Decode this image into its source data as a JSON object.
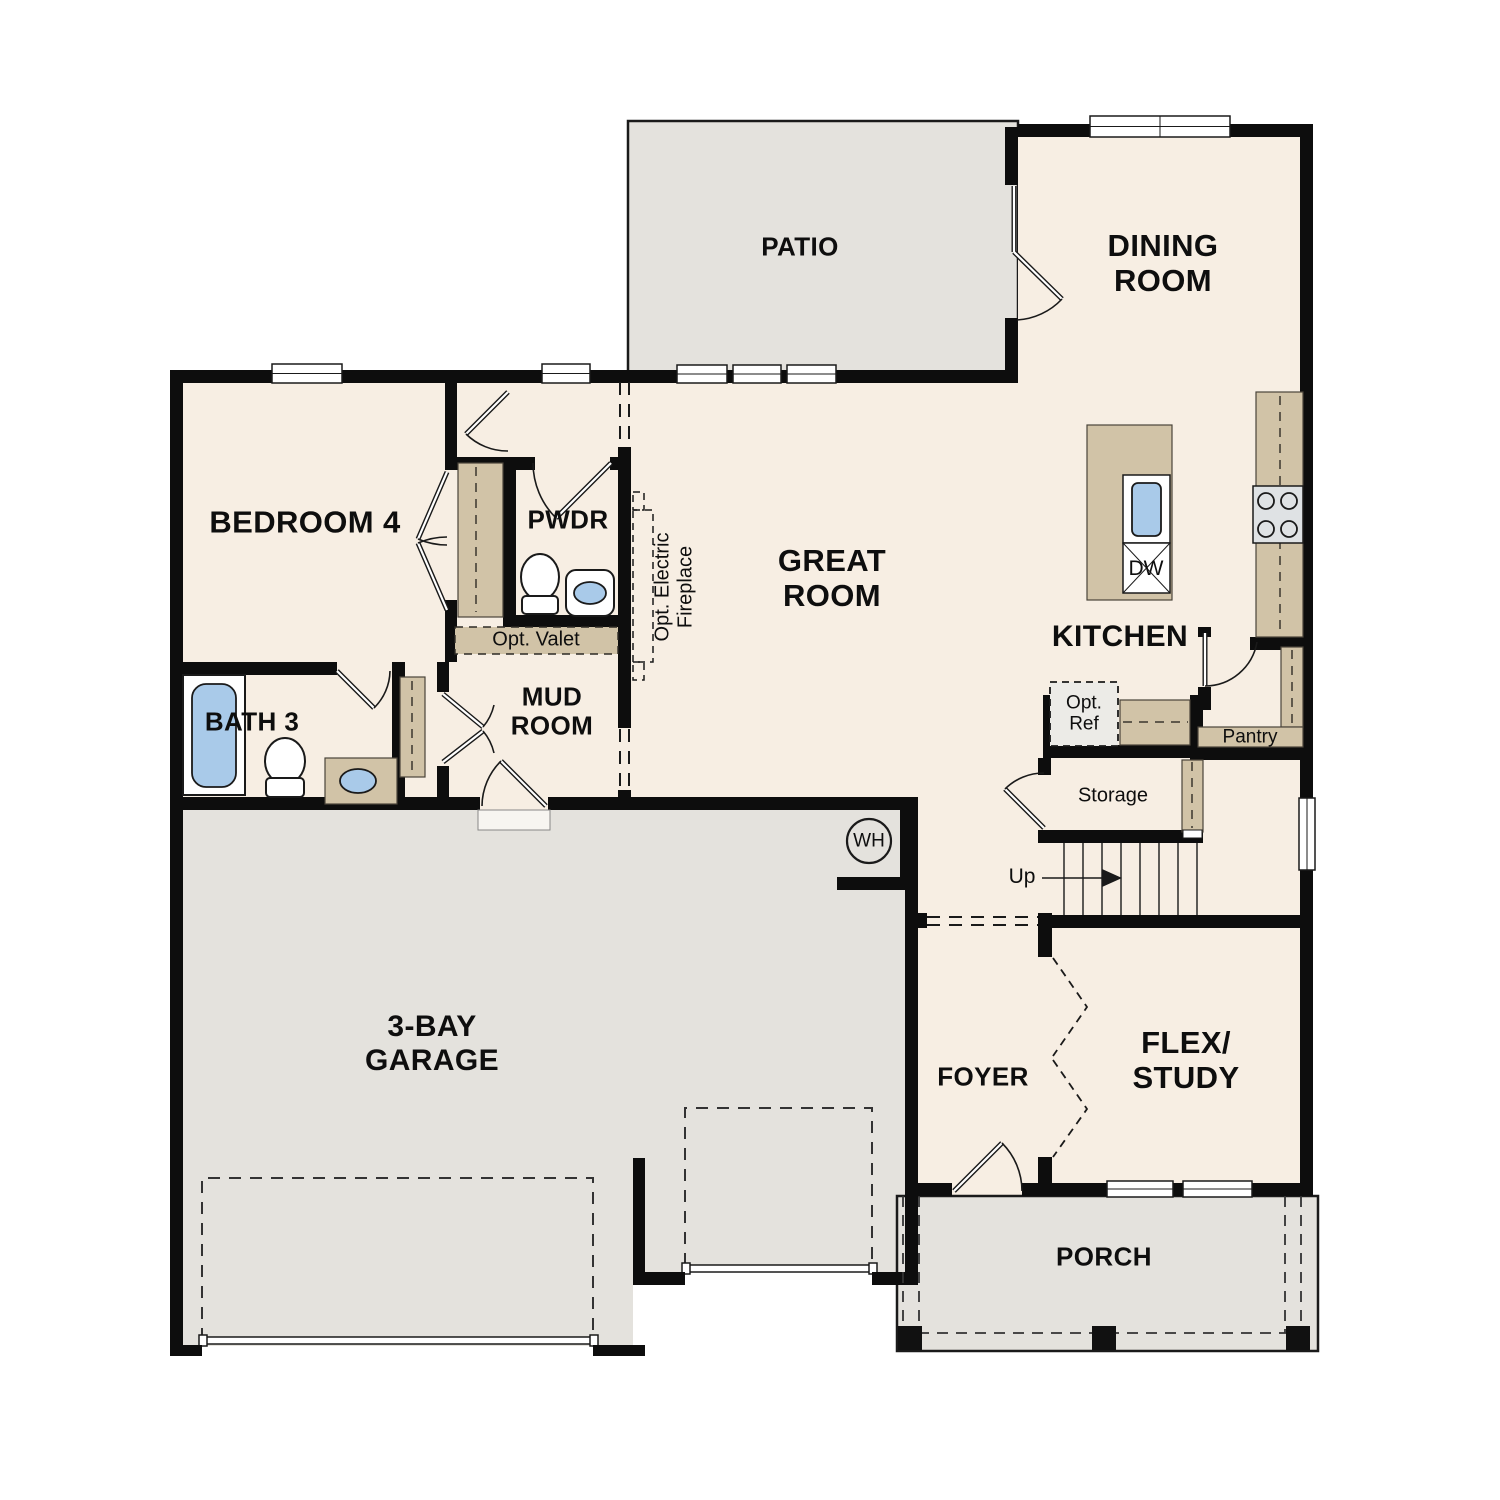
{
  "colors": {
    "floor_cream": "#f7eee3",
    "exterior_gray": "#e4e2dd",
    "cabinet_tan": "#d1c3a7",
    "fixture_blue": "#a9cae9",
    "wall_black": "#0d0d0d",
    "line_dark": "#1a1a1a"
  },
  "labels": {
    "patio": "PATIO",
    "dining_room": "DINING\nROOM",
    "bedroom_4": "BEDROOM 4",
    "powder": "PWDR",
    "opt_valet": "Opt. Valet",
    "mud_room": "MUD\nROOM",
    "bath_3": "BATH 3",
    "great_room": "GREAT\nROOM",
    "kitchen": "KITCHEN",
    "dishwasher": "DW",
    "opt_ref": "Opt.\nRef",
    "pantry": "Pantry",
    "storage": "Storage",
    "stairs_up": "Up",
    "water_heater": "WH",
    "garage": "3-BAY\nGARAGE",
    "foyer": "FOYER",
    "flex_study": "FLEX/\nSTUDY",
    "porch": "PORCH",
    "opt_fireplace": "Opt. Electric\nFireplace"
  }
}
